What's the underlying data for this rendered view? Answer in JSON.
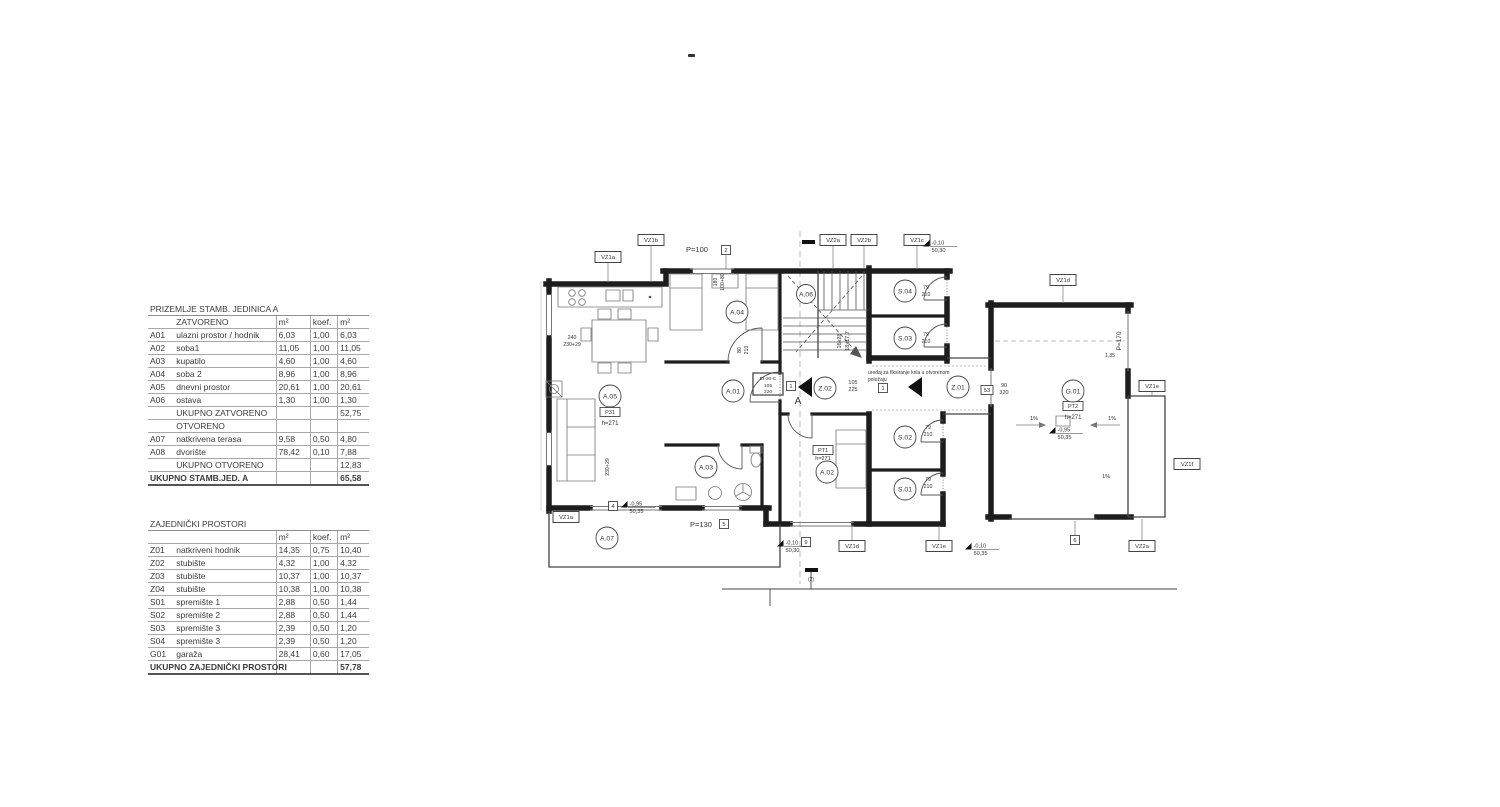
{
  "colors": {
    "ink": "#1d1d1d",
    "thin_line": "#555555",
    "table_line": "#a8a8a8"
  },
  "tables": {
    "unit_a": {
      "title": "PRIZEMLJE STAMB. JEDINICA A",
      "header": {
        "c1": "",
        "c2": "ZATVORENO",
        "c3": "m²",
        "c4": "koef.",
        "c5": "m²"
      },
      "rows": [
        {
          "code": "A01",
          "name": "ulazni prostor / hodnik",
          "m2": "6,03",
          "koef": "1,00",
          "tot": "6,03"
        },
        {
          "code": "A02",
          "name": "soba1",
          "m2": "11,05",
          "koef": "1,00",
          "tot": "11,05"
        },
        {
          "code": "A03",
          "name": "kupatilo",
          "m2": "4,60",
          "koef": "1,00",
          "tot": "4,60"
        },
        {
          "code": "A04",
          "name": "soba 2",
          "m2": "8,96",
          "koef": "1,00",
          "tot": "8,96"
        },
        {
          "code": "A05",
          "name": "dnevni prostor",
          "m2": "20,61",
          "koef": "1,00",
          "tot": "20,61"
        },
        {
          "code": "A06",
          "name": "ostava",
          "m2": "1,30",
          "koef": "1,00",
          "tot": "1,30"
        },
        {
          "name": "UKUPNO ZATVORENO",
          "tot": "52,75",
          "cls": "sum"
        },
        {
          "name": "OTVORENO",
          "cls": "sub"
        },
        {
          "code": "A07",
          "name": "natkrivena terasa",
          "m2": "9,58",
          "koef": "0,50",
          "tot": "4,80"
        },
        {
          "code": "A08",
          "name": "dvorište",
          "m2": "78,42",
          "koef": "0,10",
          "tot": "7,88"
        },
        {
          "name": "UKUPNO OTVORENO",
          "tot": "12,83",
          "cls": "sum"
        },
        {
          "code": "UKUPNO STAMB.JED. A",
          "tot": "65,58",
          "cls": "total"
        }
      ]
    },
    "common": {
      "title": "ZAJEDNIČKI PROSTORI",
      "header": {
        "c1": "",
        "c2": "",
        "c3": "m²",
        "c4": "koef.",
        "c5": "m²"
      },
      "rows": [
        {
          "code": "Z01",
          "name": "natkriveni hodnik",
          "m2": "14,35",
          "koef": "0,75",
          "tot": "10,40"
        },
        {
          "code": "Z02",
          "name": "stubište",
          "m2": "4,32",
          "koef": "1,00",
          "tot": "4,32"
        },
        {
          "code": "Z03",
          "name": "stubište",
          "m2": "10,37",
          "koef": "1,00",
          "tot": "10,37"
        },
        {
          "code": "Z04",
          "name": "stubište",
          "m2": "10,38",
          "koef": "1,00",
          "tot": "10,38"
        },
        {
          "code": "S01",
          "name": "spremište 1",
          "m2": "2,88",
          "koef": "0,50",
          "tot": "1,44"
        },
        {
          "code": "S02",
          "name": "spremište 2",
          "m2": "2,88",
          "koef": "0,50",
          "tot": "1,44"
        },
        {
          "code": "S03",
          "name": "spremište 3",
          "m2": "2,39",
          "koef": "0,50",
          "tot": "1,20"
        },
        {
          "code": "S04",
          "name": "spremište 3",
          "m2": "2,39",
          "koef": "0,50",
          "tot": "1,20"
        },
        {
          "code": "G01",
          "name": "garaža",
          "m2": "28,41",
          "koef": "0,60",
          "tot": "17,05"
        },
        {
          "code": "UKUPNO ZAJEDNIČKI PROSTORI",
          "tot": "57,78",
          "cls": "total"
        }
      ]
    }
  },
  "plan": {
    "rooms": [
      {
        "t": "A.05",
        "x": 610,
        "y": 396
      },
      {
        "t": "A.04",
        "x": 737,
        "y": 312
      },
      {
        "t": "A.06",
        "x": 806,
        "y": 294,
        "r": 9.5
      },
      {
        "t": "A.01",
        "x": 733,
        "y": 391
      },
      {
        "t": "A.03",
        "x": 706,
        "y": 467
      },
      {
        "t": "A.02",
        "x": 827,
        "y": 472
      },
      {
        "t": "A.07",
        "x": 607,
        "y": 538
      },
      {
        "t": "Z.02",
        "x": 825,
        "y": 388
      },
      {
        "t": "Z.01",
        "x": 958,
        "y": 387
      },
      {
        "t": "S.04",
        "x": 905,
        "y": 291
      },
      {
        "t": "S.03",
        "x": 905,
        "y": 338
      },
      {
        "t": "S.02",
        "x": 905,
        "y": 437
      },
      {
        "t": "S.01",
        "x": 905,
        "y": 489
      },
      {
        "t": "G.01",
        "x": 1073,
        "y": 391
      }
    ],
    "tags": [
      {
        "t": "P31",
        "x": 610,
        "y": 412
      },
      {
        "t": "PT1",
        "x": 823,
        "y": 450
      },
      {
        "t": "PT2",
        "x": 1073,
        "y": 406
      }
    ],
    "vz": [
      {
        "t": "VZ1a",
        "x": 608,
        "y": 257,
        "ly": 282
      },
      {
        "t": "VZ1b",
        "x": 651,
        "y": 240,
        "ly": 282
      },
      {
        "t": "VZ2a",
        "x": 833,
        "y": 240,
        "ly": 269
      },
      {
        "t": "VZ2b",
        "x": 864,
        "y": 240,
        "ly": 269
      },
      {
        "t": "VZ1c",
        "x": 917,
        "y": 240,
        "ly": 269
      },
      {
        "t": "VZ1d",
        "x": 1063,
        "y": 280,
        "ly": 303
      },
      {
        "t": "VZ1e",
        "x": 1152,
        "y": 386,
        "ly": 397
      },
      {
        "t": "VZ1f",
        "x": 1187,
        "y": 464
      },
      {
        "t": "VZ1a",
        "x": 566,
        "y": 517
      },
      {
        "t": "VZ1d",
        "x": 852,
        "y": 546,
        "ly": 526
      },
      {
        "t": "VZ1e",
        "x": 939,
        "y": 546,
        "ly": 526
      },
      {
        "t": "VZ2a",
        "x": 1142,
        "y": 546,
        "ly": 519
      }
    ],
    "numbox": [
      {
        "t": "2",
        "x": 726,
        "y": 250,
        "ly": 269
      },
      {
        "t": "1",
        "x": 791,
        "y": 386
      },
      {
        "t": "1",
        "x": 883,
        "y": 388
      },
      {
        "t": "4",
        "x": 613,
        "y": 506
      },
      {
        "t": "5",
        "x": 724,
        "y": 524
      },
      {
        "t": "9",
        "x": 806,
        "y": 542
      },
      {
        "t": "6",
        "x": 1075,
        "y": 540,
        "ly": 521
      },
      {
        "t": "53",
        "x": 987,
        "y": 390
      }
    ],
    "elev": [
      {
        "a": "-0,10",
        "b": "50,30",
        "x": 936,
        "y": 243
      },
      {
        "a": "-0,95",
        "b": "50,35",
        "x": 634,
        "y": 504
      },
      {
        "a": "-0,10",
        "b": "50,30",
        "x": 790,
        "y": 543
      },
      {
        "a": "-0,10",
        "b": "50,35",
        "x": 978,
        "y": 546
      },
      {
        "a": "-0,95",
        "b": "50,35",
        "x": 1062,
        "y": 430
      }
    ],
    "notes": [
      {
        "t": "P=100",
        "x": 697,
        "y": 252,
        "f": 7.5
      },
      {
        "t": "P=130",
        "x": 701,
        "y": 527,
        "f": 7.5
      },
      {
        "t": "P=170",
        "x": 1121,
        "y": 341,
        "f": 6.5,
        "r": -90
      },
      {
        "t": "h=271",
        "x": 610,
        "y": 425,
        "f": 6
      },
      {
        "t": "h=271",
        "x": 823,
        "y": 460,
        "f": 5.5
      },
      {
        "t": "h=271",
        "x": 1073,
        "y": 419,
        "f": 6
      },
      {
        "t": "16x28",
        "x": 841,
        "y": 341,
        "f": 5.5,
        "r": -90
      },
      {
        "t": "18x17,7",
        "x": 849,
        "y": 341,
        "f": 5.5,
        "r": -90
      },
      {
        "t": "105",
        "x": 853,
        "y": 384,
        "f": 5.5
      },
      {
        "t": "225",
        "x": 853,
        "y": 391,
        "f": 5.5
      },
      {
        "t": "90",
        "x": 1004,
        "y": 387,
        "f": 5.5
      },
      {
        "t": "320",
        "x": 1004,
        "y": 394,
        "f": 5.5
      },
      {
        "t": "EI-30-C",
        "x": 768,
        "y": 380,
        "f": 4.8
      },
      {
        "t": "105",
        "x": 768,
        "y": 387,
        "f": 4.8
      },
      {
        "t": "220",
        "x": 768,
        "y": 393,
        "f": 4.8
      },
      {
        "t": "240",
        "x": 572,
        "y": 339,
        "f": 5.2
      },
      {
        "t": "230+29",
        "x": 572,
        "y": 346,
        "f": 5.2
      },
      {
        "t": "230+29",
        "x": 609,
        "y": 467,
        "f": 5.2,
        "r": -90
      },
      {
        "t": "180",
        "x": 717,
        "y": 282,
        "f": 5.2,
        "r": -90
      },
      {
        "t": "100+80",
        "x": 724,
        "y": 282,
        "f": 5.2,
        "r": -90
      },
      {
        "t": "80",
        "x": 741,
        "y": 350,
        "f": 5.2,
        "r": -90
      },
      {
        "t": "210",
        "x": 748,
        "y": 350,
        "f": 5.2,
        "r": -90
      },
      {
        "t": "79",
        "x": 926,
        "y": 289,
        "f": 5.2
      },
      {
        "t": "210",
        "x": 926,
        "y": 296,
        "f": 5.2
      },
      {
        "t": "79",
        "x": 926,
        "y": 336,
        "f": 5.2
      },
      {
        "t": "210",
        "x": 926,
        "y": 343,
        "f": 5.2
      },
      {
        "t": "79",
        "x": 928,
        "y": 429,
        "f": 5.2
      },
      {
        "t": "210",
        "x": 928,
        "y": 436,
        "f": 5.2
      },
      {
        "t": "79",
        "x": 928,
        "y": 481,
        "f": 5.2
      },
      {
        "t": "210",
        "x": 928,
        "y": 488,
        "f": 5.2
      },
      {
        "t": "uređaj za fiksiranje krila u otvorenom",
        "x": 868,
        "y": 374,
        "f": 5,
        "a": "start"
      },
      {
        "t": "položaju",
        "x": 868,
        "y": 381,
        "f": 5,
        "a": "start"
      },
      {
        "t": "A",
        "x": 798,
        "y": 404,
        "f": 10
      },
      {
        "t": "1%",
        "x": 1034,
        "y": 420,
        "f": 5.5
      },
      {
        "t": "1%",
        "x": 1112,
        "y": 420,
        "f": 5.5
      },
      {
        "t": "1%",
        "x": 1106,
        "y": 478,
        "f": 5.5
      },
      {
        "t": "1,35",
        "x": 1110,
        "y": 357,
        "f": 5.2
      },
      {
        "t": "(2)",
        "x": 811,
        "y": 581,
        "f": 5
      }
    ]
  }
}
